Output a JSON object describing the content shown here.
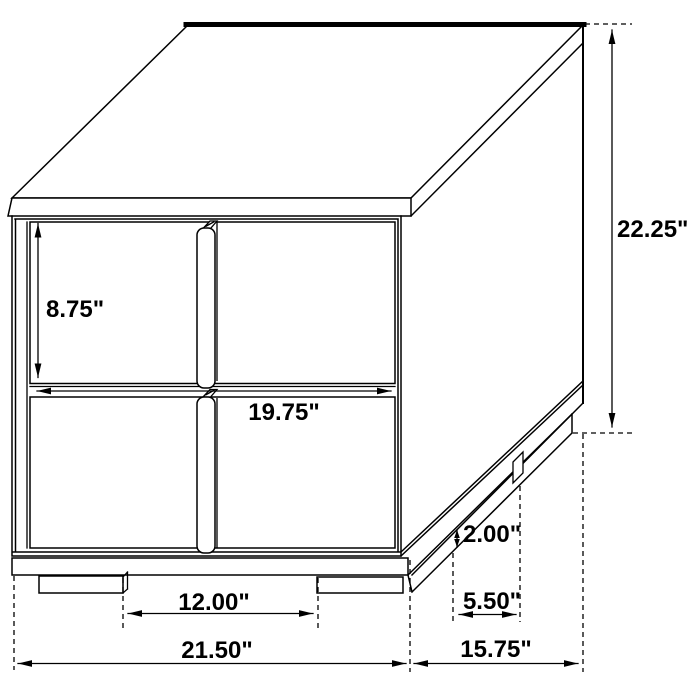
{
  "figure": {
    "kind": "furniture-dimension-drawing",
    "background_color": "#ffffff",
    "line_color": "#000000",
    "text_color": "#000000"
  },
  "dimensions": {
    "overall_height": {
      "label": "22.25\""
    },
    "drawer_height": {
      "label": "8.75\""
    },
    "drawer_width": {
      "label": "19.75\""
    },
    "front_leg_gap": {
      "label": "12.00\""
    },
    "overall_width": {
      "label": "21.50\""
    },
    "overall_depth": {
      "label": "15.75\""
    },
    "side_leg_spacing": {
      "label": "5.50\""
    },
    "leg_height": {
      "label": "2.00\""
    }
  }
}
